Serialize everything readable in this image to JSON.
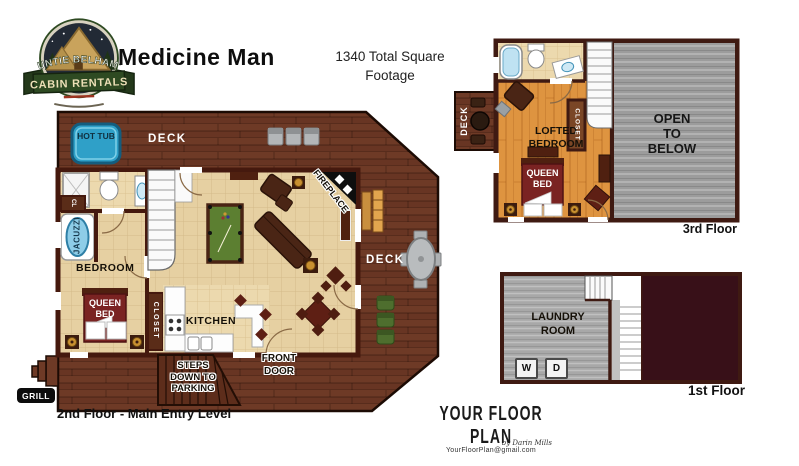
{
  "header": {
    "title": "Medicine Man",
    "sqft_line1": "1340 Total Square",
    "sqft_line2": "Footage"
  },
  "logo": {
    "arc_text": "AUNTIE BELHAM'S",
    "ribbon_text": "CABIN RENTALS"
  },
  "floor2": {
    "caption": "2nd Floor - Main Entry Level",
    "deck_top": "DECK",
    "deck_right": "DECK",
    "hot_tub": "HOT TUB",
    "jacuzzi": "JACUZZI",
    "cl": "CL",
    "bedroom": "BEDROOM",
    "queen_bed": "QUEEN BED",
    "closet": "CLOSET",
    "kitchen": "KITCHEN",
    "fireplace": "FIREPLACE",
    "front_door": "FRONT DOOR",
    "steps": "STEPS DOWN TO PARKING",
    "grill": "GRILL"
  },
  "floor3": {
    "caption": "3rd Floor",
    "deck": "DECK",
    "lofted_bedroom": "LOFTED BEDROOM",
    "queen_bed": "QUEEN BED",
    "closet": "CLOSET",
    "open_to_below": "OPEN TO BELOW"
  },
  "floor1": {
    "caption": "1st Floor",
    "laundry": "LAUNDRY ROOM",
    "washer": "W",
    "dryer": "D"
  },
  "footer": {
    "brand": "YOUR FLOOR PLAN",
    "byline": "by Darin Mills",
    "email": "YourFloorPlan@gmail.com"
  },
  "colors": {
    "deck_brown": "#6e3a26",
    "wall_maroon": "#45190e",
    "interior_tan": "#e6d0a2",
    "loft_wood": "#de9440",
    "open_gray": "#9c9c9c",
    "hot_tub_blue": "#2fa0c8",
    "bed_maroon": "#7a2322",
    "pool_green": "#5c7f31",
    "dark_room": "#381018"
  }
}
